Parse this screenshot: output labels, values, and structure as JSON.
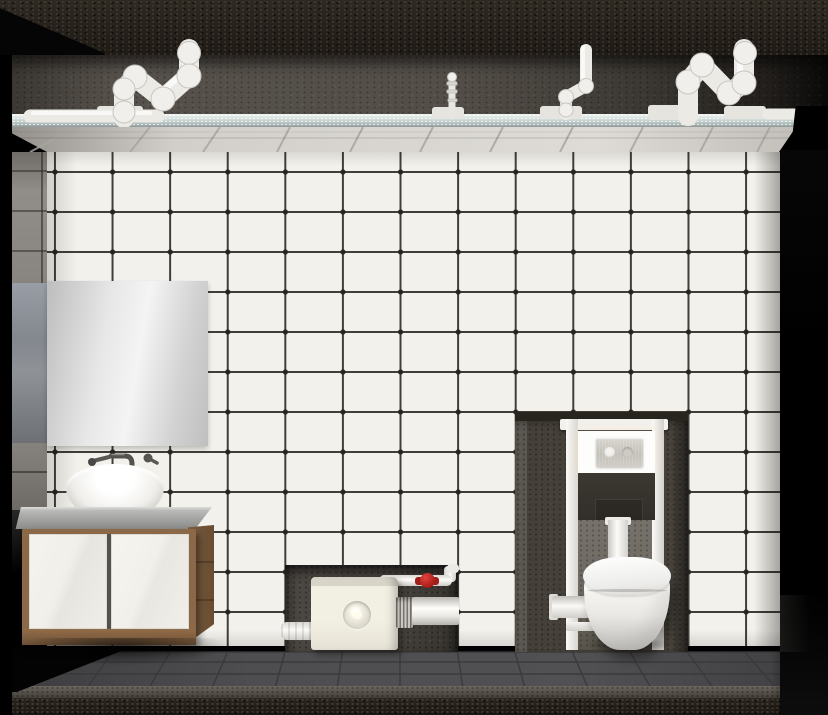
{
  "scene": {
    "title": "bathroom-sanitary-installation-render",
    "labels": {
      "flush_plate_brand": "OLI"
    },
    "palette": {
      "tile_white": "#f3f1eb",
      "grout_dark": "#413e39",
      "ceiling_edge": "#cfdad8",
      "concrete_strip": "#514c46",
      "niche_concrete": "#46423d",
      "floor_gray": "#4b4b4d",
      "wood_brown": "#8a6848",
      "pump_cream": "#f1eee3",
      "fixture_white": "#f4f3ef",
      "valve_red": "#b7231e",
      "mirror_silver": "#e9e9e9"
    },
    "objects": {
      "ceiling": [
        "concrete-slab",
        "s-trap-pipe-left",
        "ceiling-run-pipe",
        "vent-pipe-small",
        "s-trap-pipe-middle",
        "s-trap-pipe-right",
        "suspended-ceiling-panel"
      ],
      "wall": [
        "white-tile-grid",
        "left-side-wall"
      ],
      "vanity_zone": [
        "mirror",
        "wall-faucet",
        "vessel-sink",
        "countertop",
        "vanity-cabinet"
      ],
      "pump_zone": [
        "wall-niche",
        "macerator-pump",
        "inlet-pipe",
        "discharge-pipe",
        "shutoff-valve-red",
        "corrugated-coupling"
      ],
      "toilet_zone": [
        "installation-niche",
        "cistern-frame",
        "flush-plate",
        "brand-label",
        "concealed-cistern",
        "flush-pipe",
        "wall-hung-toilet",
        "outlet-pipe"
      ],
      "floor": [
        "dark-tile-floor",
        "screed-edge",
        "gravel-band"
      ]
    }
  }
}
